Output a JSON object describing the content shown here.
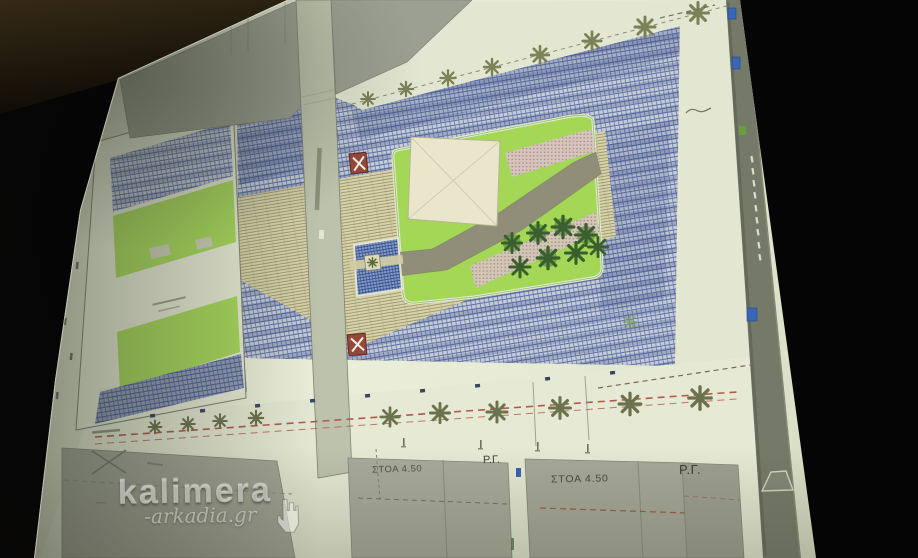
{
  "watermark": {
    "brand": "kalimera",
    "site": "-arkadia.gr"
  },
  "plan_labels": {
    "stoa_left": "ΣΤΟΑ 4.50",
    "rg_left": "Ρ.Γ.",
    "stoa_right": "ΣΤΟΑ 4.50",
    "rg_right": "Ρ.Γ."
  },
  "colors": {
    "room_black": "#070707",
    "ceiling_brown": "#2e2614",
    "screen_paper": "#e9ecd7",
    "street_gray": "#9ba092",
    "paving_blue_line": "#5d70a8",
    "carpet_tan": "#d8d3ad",
    "lawn_green": "#a3d755",
    "lime_patch": "#a8d95c",
    "tree_cluster_green": "#3b5e2f",
    "tree_row_olive": "#7c8158",
    "path_gray": "#908d78",
    "pink_paving": "#dcc2c8",
    "pool_blue": "#8a9cc5",
    "marker_red": "#95483a",
    "dashed_red": "#b25a49",
    "edge_band_gray": "#747968",
    "edge_marker_blue": "#3a66b6"
  }
}
